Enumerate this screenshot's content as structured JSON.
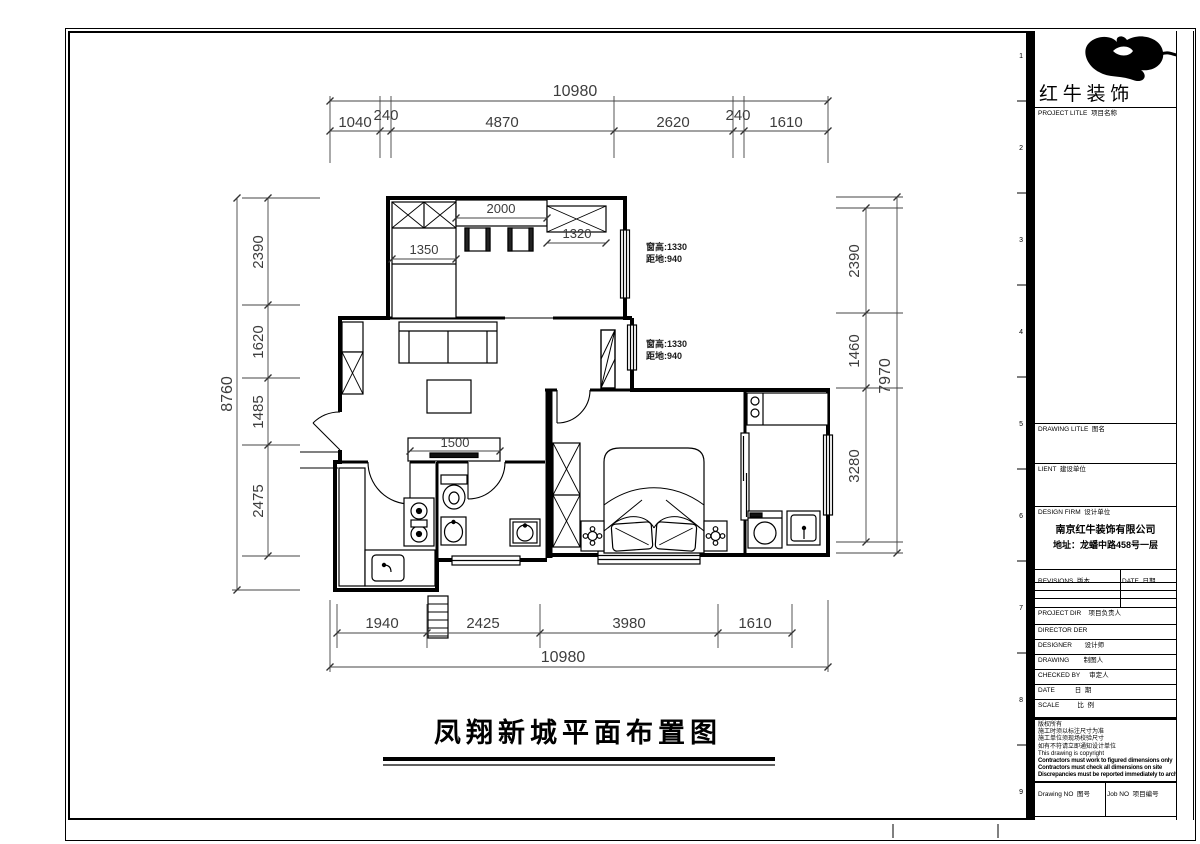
{
  "sheet": {
    "background": "#ffffff",
    "ink": "#000000"
  },
  "plan": {
    "title": "凤翔新城平面布置图",
    "dims_top": {
      "overall": "10980",
      "seg": [
        "1040",
        "240",
        "4870",
        "2620",
        "240",
        "1610"
      ]
    },
    "dims_bottom": {
      "overall": "10980",
      "seg": [
        "1940",
        "2425",
        "3980",
        "1610"
      ]
    },
    "dims_left": {
      "overall": "8760",
      "seg": [
        "2390",
        "1620",
        "1485",
        "2475"
      ]
    },
    "dims_right": {
      "overall": "7970",
      "seg": [
        "2390",
        "1460",
        "3280"
      ]
    },
    "dims_interior": {
      "closet": "1350",
      "desk": "2000",
      "cabinet": "1320",
      "tv_cabinet": "1500"
    },
    "window_notes": {
      "note1_line1": "窗高:1330",
      "note1_line2": "距地:940",
      "note2_line1": "窗高:1330",
      "note2_line2": "距地:940"
    }
  },
  "grid_refs": [
    "1",
    "2",
    "3",
    "4",
    "5",
    "6",
    "7",
    "8",
    "9"
  ],
  "titleblock": {
    "brand": "红 牛 装 饰",
    "project_title_label": "PROJECT LITLE  项目名称",
    "drawing_title_label": "DRAWING LITLE  图名",
    "client_label": "LIENT  建设单位",
    "design_firm_label": "DESIGN FIRM  设计单位",
    "company_name": "南京红牛装饰有限公司",
    "company_address": "地址：龙蟠中路458号一层",
    "revisions_label": "REVISIONS  版本",
    "revision_date_label": "DATE  日期",
    "project_dir_label": "PROJECT DIR    项目负责人",
    "director_label": "DIRECTOR DER",
    "designer_label": "DESIGNER       设计师",
    "drawing_by_label": "DRAWING        制图人",
    "checked_by_label": "CHECKED BY     审定人",
    "date_label": "DATE           日  期",
    "scale_label": "SCALE          比  例",
    "copyright_lines": [
      "版权所有",
      "施工时须以标注尺寸为准",
      "施工单位须现场校验尺寸",
      "如有不符请立即通知设计单位",
      "This drawing is copyright",
      "Contractors must work to figured dimensions only",
      "Contractors must check all dimensions on site",
      "Discrepancies must be reported immediately to architects"
    ],
    "drawing_no_label": "Drawing NO  图号",
    "job_no_label": "Job NO  项目编号"
  }
}
